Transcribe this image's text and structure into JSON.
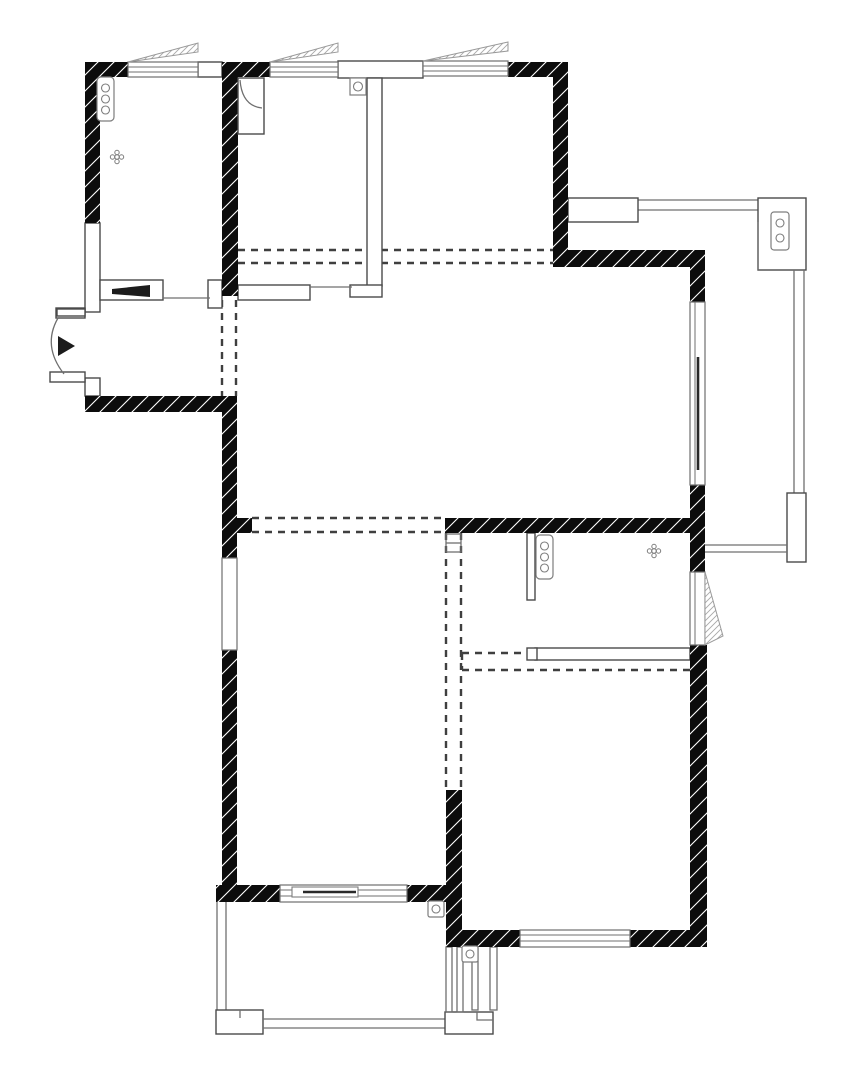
{
  "document": {
    "kind": "residential apartment floor plan",
    "style": "black-and-white CAD line drawing",
    "visible_text": "none",
    "orientation": "portrait"
  },
  "canvas": {
    "width": 860,
    "height": 1090,
    "background": "#ffffff"
  },
  "colors": {
    "wall_fill": "#0c0c0c",
    "wall_hatch": "#ffffff",
    "partition_stroke": "#4a4a4a",
    "thin_line": "#6f6f6f",
    "dashed_line": "#3f3f3f",
    "swing_hatch_stroke": "#9a9a9a",
    "symbol_stroke": "#7d7d7d",
    "dark_accent": "#1c1c1c"
  },
  "features": {
    "load_bearing_walls": "solid black with diagonal white hatch ticks",
    "non_bearing_partitions": "thin white outlined walls",
    "beam_or_removed_wall_lines": "paired gray dashed lines",
    "casement_windows_top": 3,
    "casement_window_right": 1,
    "fixed_window_left": 1,
    "sliding_balcony_doors": 2,
    "entry_door": "left side, outward swing arc with solid entry arrow",
    "pocket_sliding_door": "tapered black wedge in top-left room partition",
    "balconies": [
      "top-right open balcony with railing posts",
      "bottom center balcony with railing and corner posts",
      "small service shaft lower center"
    ],
    "electrical_symbols": [
      "triple-socket plate top-left room",
      "triple-socket plate middle-right room",
      "double-socket plate top-right balcony post",
      "single-socket top-middle room",
      "single-socket bottom balcony",
      "single-socket service shaft"
    ],
    "ceiling_light_symbols": 2
  }
}
